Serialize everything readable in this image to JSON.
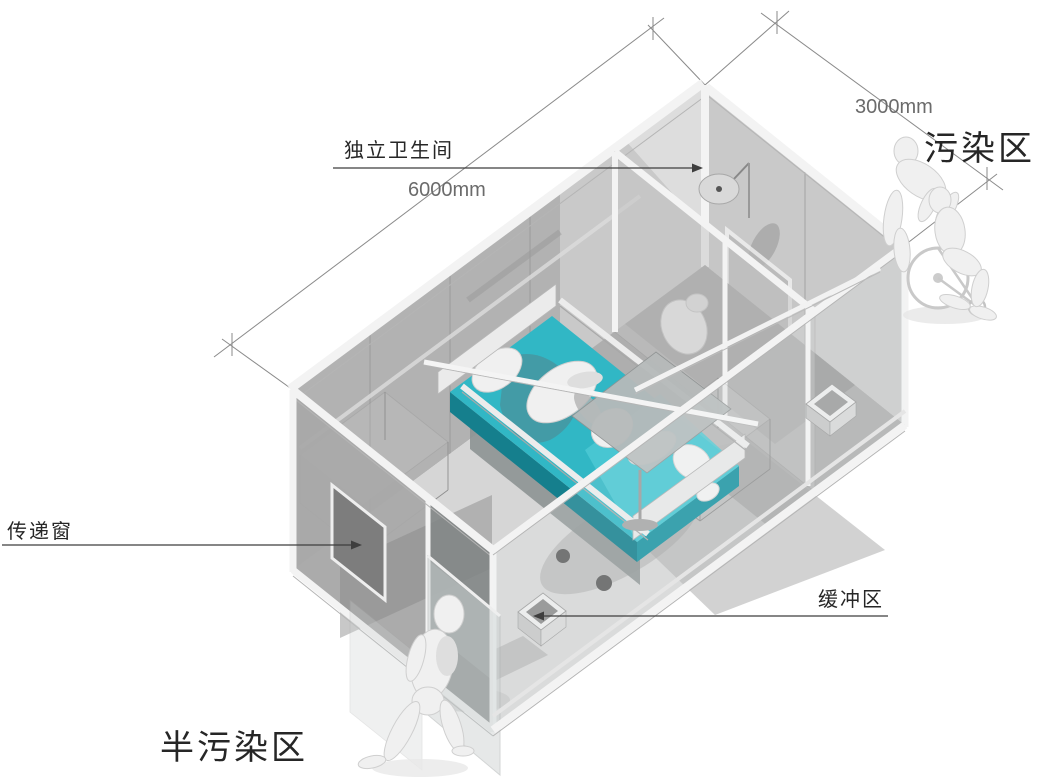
{
  "diagram": {
    "zone_labels": {
      "contaminated": "污染区",
      "semi_contaminated": "半污染区"
    },
    "callouts": {
      "bathroom": "独立卫生间",
      "transfer_window": "传递窗",
      "buffer_zone": "缓冲区"
    },
    "dimensions": {
      "length": "6000mm",
      "width": "3000mm"
    },
    "colors": {
      "bed_teal": "#31b7c5",
      "bed_teal_dark": "#157f8d",
      "wall_gray": "#b2b2b2",
      "floor_gray": "#d6d6d6",
      "figure_gray": "#f0f0f0",
      "label_text": "#262626",
      "dimension_text": "#6b6b6b",
      "line_gray": "#8a8a8a"
    }
  }
}
